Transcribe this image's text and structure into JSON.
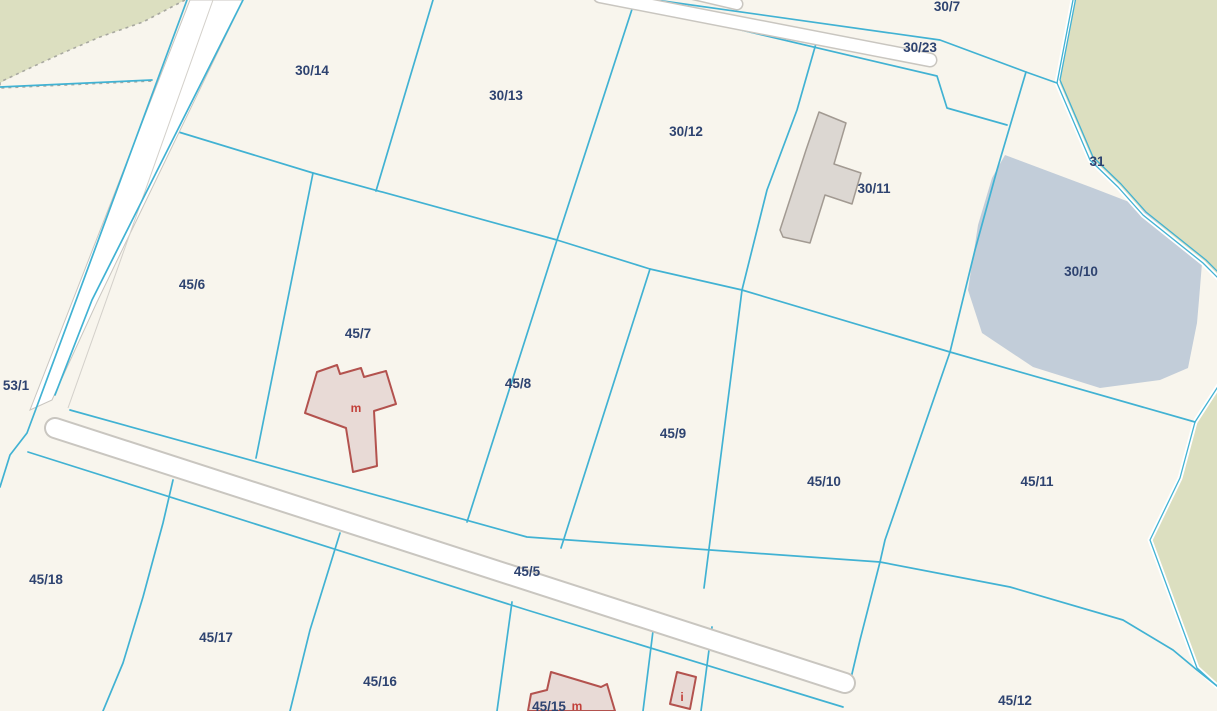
{
  "map": {
    "labels": {
      "p30_7": "30/7",
      "p30_23": "30/23",
      "p30_14": "30/14",
      "p30_13": "30/13",
      "p30_12": "30/12",
      "p30_11": "30/11",
      "p30_10": "30/10",
      "p31": "31",
      "p45_6": "45/6",
      "p45_7": "45/7",
      "p45_8": "45/8",
      "p45_9": "45/9",
      "p45_10": "45/10",
      "p45_11": "45/11",
      "p45_12": "45/12",
      "p45_5": "45/5",
      "p45_15": "45/15",
      "p45_16": "45/16",
      "p45_17": "45/17",
      "p45_18": "45/18",
      "p53_1": "53/1",
      "bld_m1": "m",
      "bld_m2": "m",
      "bld_i": "i"
    },
    "colors": {
      "background": "#f8f5ed",
      "forest": "#dcdfc0",
      "water": "#c2cdd9",
      "parcel_boundary": "#41b2d3",
      "parcel_label": "#2e4370",
      "building_outline": "#b3524e",
      "building_fill": "#e8dad6",
      "outbuilding_fill": "#dcd7d2",
      "road_fill": "#ffffff",
      "road_casing": "#c9c6c0"
    }
  }
}
